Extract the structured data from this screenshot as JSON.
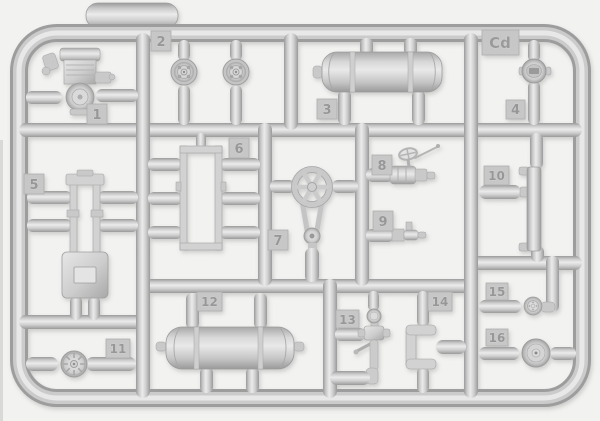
{
  "sprue": {
    "code": "Cd",
    "part_labels": [
      "1",
      "2",
      "3",
      "4",
      "5",
      "6",
      "7",
      "8",
      "9",
      "10",
      "11",
      "12",
      "13",
      "14",
      "15",
      "16"
    ]
  },
  "colors": {
    "background": "#f2f2f0",
    "plastic_highlight": "#ebebeb",
    "plastic_base": "#cccccc",
    "plastic_shadow": "#9a9a9a",
    "tag_fill": "#c7c7c7",
    "tag_text": "#979797"
  }
}
